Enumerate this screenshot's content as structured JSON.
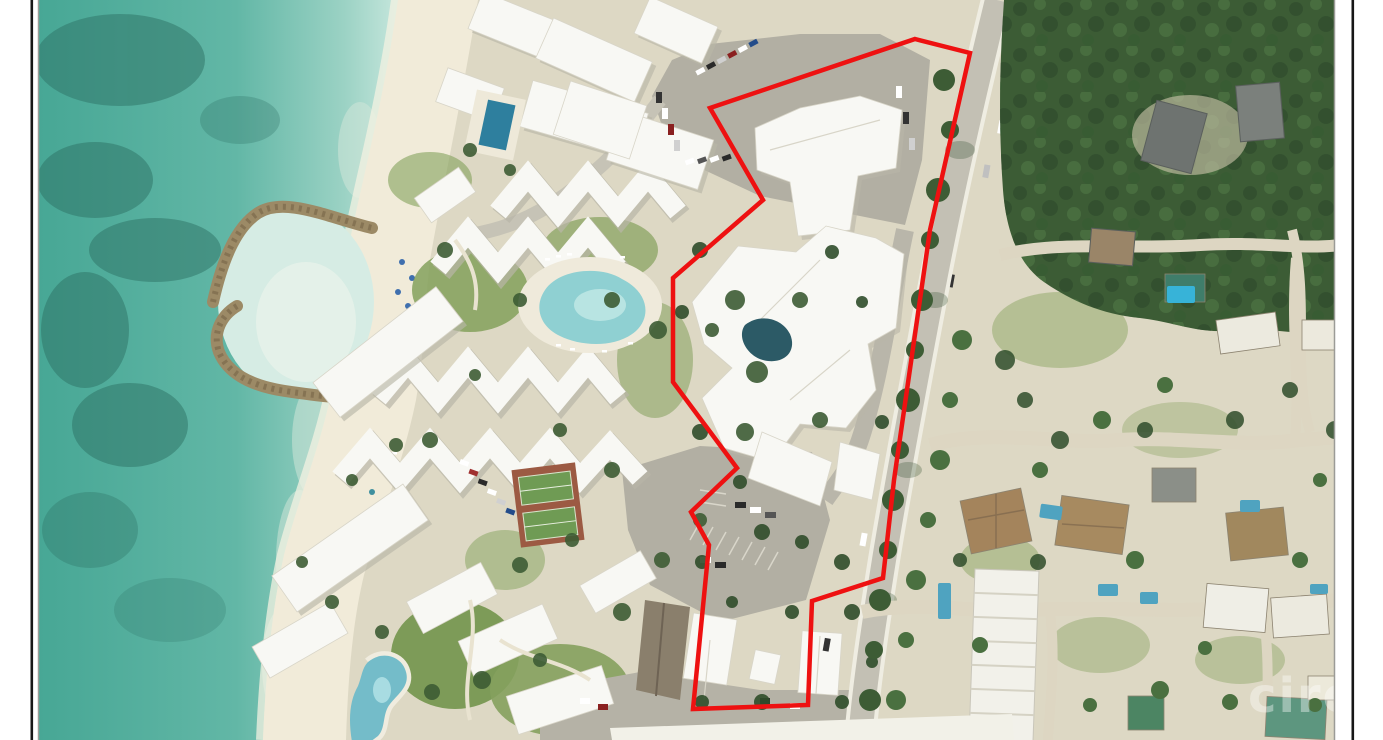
{
  "page": {
    "type": "listing-photo-page",
    "background": "#ffffff",
    "frame_color": "#161616",
    "photo_border_color": "#9b9b97"
  },
  "photo": {
    "kind": "aerial-satellite-photo",
    "subject": "beachfront resort property with outlined parcel, ocean at left, main road and residential area at right"
  },
  "boundary": {
    "color": "#ee1111",
    "stroke_width": 4.5,
    "points": "915,39 970,53 930,230 894,480 883,578 812,601 808,705 693,709 709,545 691,512 737,468 673,382 673,278 763,200 710,108"
  },
  "watermark": {
    "text": "cireba",
    "color": "#ffffff",
    "opacity": 0.38
  },
  "palette": {
    "ocean_deep": "#47a795",
    "ocean_shallow": "#9bd2c4",
    "reef_dark": "#2e7265",
    "lagoon": "#d6ece4",
    "jetty_rock": "#9c8a66",
    "beach_sand": "#f1ebd9",
    "ground": "#ddd8c4",
    "lawn": "#84a15c",
    "tree_dark": "#2f4d2b",
    "tree_mid": "#3d5c35",
    "tree_light": "#4a7040",
    "forest": "#3c5c35",
    "road": "#c3c0b4",
    "parking": "#b2afa3",
    "roof_white": "#f8f8f4",
    "roof_shadow": "#b9b6a8",
    "roof_brown": "#a4845c",
    "roof_gray": "#6e7370",
    "roof_green": "#4c8563",
    "pool_blue": "#2e7f9e",
    "pool_light": "#8fd0d2",
    "tennis_surface": "#9c5a43",
    "tennis_green": "#6f9b54"
  }
}
